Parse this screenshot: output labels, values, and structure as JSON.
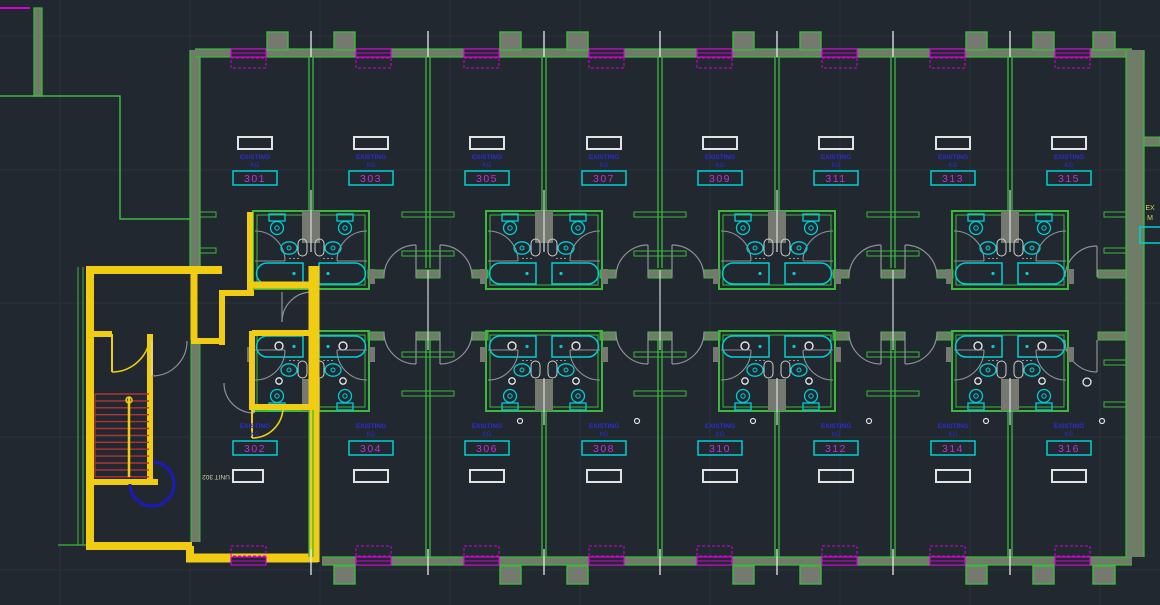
{
  "canvas": {
    "width": 1160,
    "height": 605,
    "kind": "cad-floorplan-model-space"
  },
  "rooms_top": [
    "301",
    "303",
    "305",
    "307",
    "309",
    "311",
    "313",
    "315"
  ],
  "rooms_bottom": [
    "302",
    "304",
    "306",
    "308",
    "310",
    "312",
    "314",
    "316"
  ],
  "unit_label": {
    "line1": "EXISTING",
    "line2": "KG"
  },
  "annotations": {
    "mirrored_unit_text": "UNIT 302",
    "edge_text_line1": "EX",
    "edge_text_line2": "M"
  },
  "colors": {
    "background": "#212830",
    "grid": "#2a323c",
    "wall_green": "#3cb93c",
    "wall_fill": "#6f7d68",
    "column_fill": "#757970",
    "window_magenta": "#d400d4",
    "fixture_cyan": "#00cfd4",
    "label_blue": "#2d2dd0",
    "room_number_magenta": "#c32fd4",
    "white": "#e6e6e6",
    "highlight_yellow": "#f0cd12",
    "stair_red": "#b23434",
    "door_navy": "#1b1bbb",
    "door_gray": "#8e9298",
    "mirrored_text": "#d6d0b4",
    "edge_text_yellow": "#d8d24f"
  }
}
